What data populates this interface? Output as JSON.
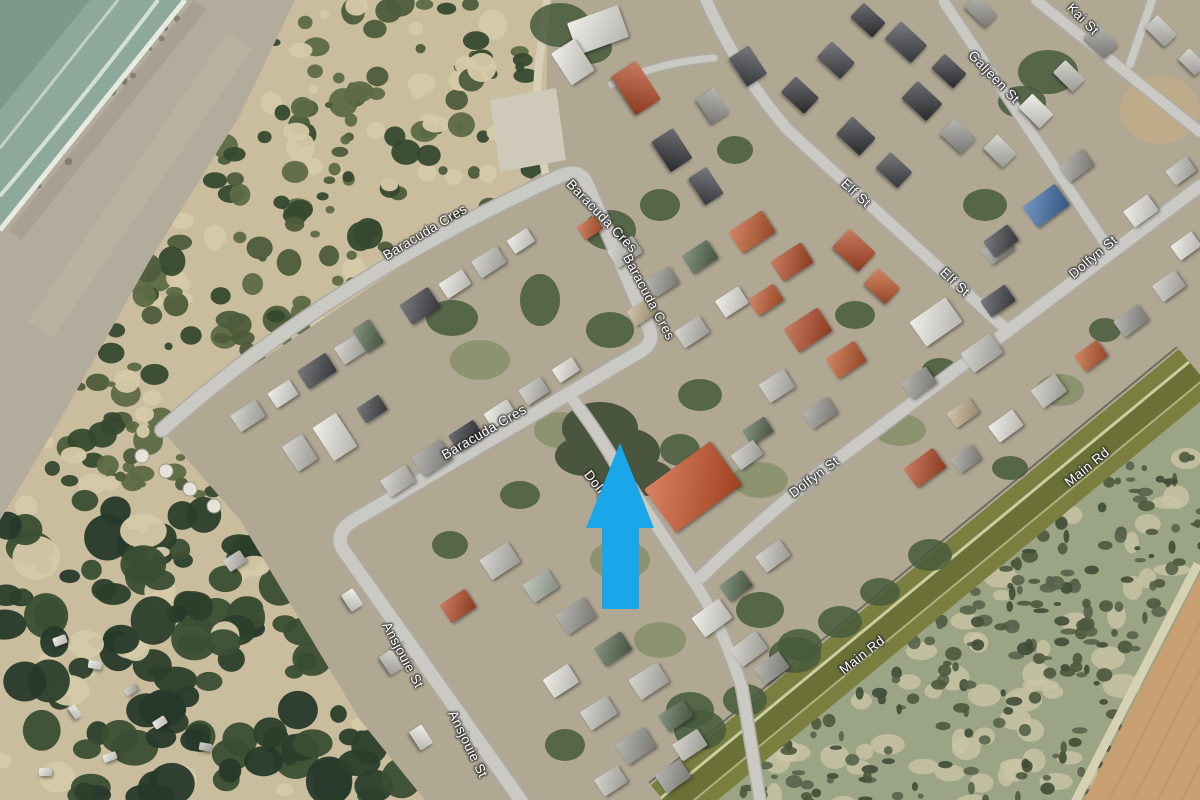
{
  "map": {
    "view": "satellite-aerial",
    "labels": [
      {
        "text": "Baracuda Cres",
        "x": 425,
        "y": 232,
        "rot": -31
      },
      {
        "text": "Baracuda Cres",
        "x": 602,
        "y": 216,
        "rot": 46
      },
      {
        "text": "Baracuda Cres",
        "x": 649,
        "y": 297,
        "rot": 62
      },
      {
        "text": "Baracuda Cres",
        "x": 484,
        "y": 432,
        "rot": -30
      },
      {
        "text": "Dolfyn St",
        "x": 605,
        "y": 495,
        "rot": 52
      },
      {
        "text": "Ansjouie St",
        "x": 403,
        "y": 655,
        "rot": 62
      },
      {
        "text": "Ansjouie St",
        "x": 468,
        "y": 744,
        "rot": 64
      },
      {
        "text": "Elf St",
        "x": 856,
        "y": 193,
        "rot": 43
      },
      {
        "text": "Elf St",
        "x": 955,
        "y": 282,
        "rot": 43
      },
      {
        "text": "Galjeen St",
        "x": 994,
        "y": 77,
        "rot": 46
      },
      {
        "text": "Kai St",
        "x": 1083,
        "y": 19,
        "rot": 45
      },
      {
        "text": "Dolfyn St",
        "x": 1093,
        "y": 257,
        "rot": -40
      },
      {
        "text": "Dolfyn St",
        "x": 814,
        "y": 477,
        "rot": -37
      },
      {
        "text": "Main Rd",
        "x": 1087,
        "y": 467,
        "rot": -39
      },
      {
        "text": "Main Rd",
        "x": 862,
        "y": 655,
        "rot": -38
      }
    ],
    "annotation": {
      "shape": "up-arrow",
      "color": "#19a7e9"
    },
    "colors": {
      "water": "#8ea99b",
      "deepWater": "#7e998c",
      "foam": "#edf2e9",
      "beachSand": "#b3ab9b",
      "duneSand": "#c9bd9e",
      "duneBush": "#36492e",
      "forest": "#2c3f2b",
      "townGround": "#b1a894",
      "road": "#cac9c4",
      "roadCasing": "#aeaca4",
      "mainRoadVerge": "#7a7f40",
      "mainRoadSurface": "#6b7036",
      "mainRoadLine": "#d6d6ac",
      "scrub": "#9ba484",
      "scrubBush": "#4c583d",
      "field": "#c89f70",
      "fieldFurrow": "#bb9260",
      "labelText": "#ffffff"
    }
  }
}
